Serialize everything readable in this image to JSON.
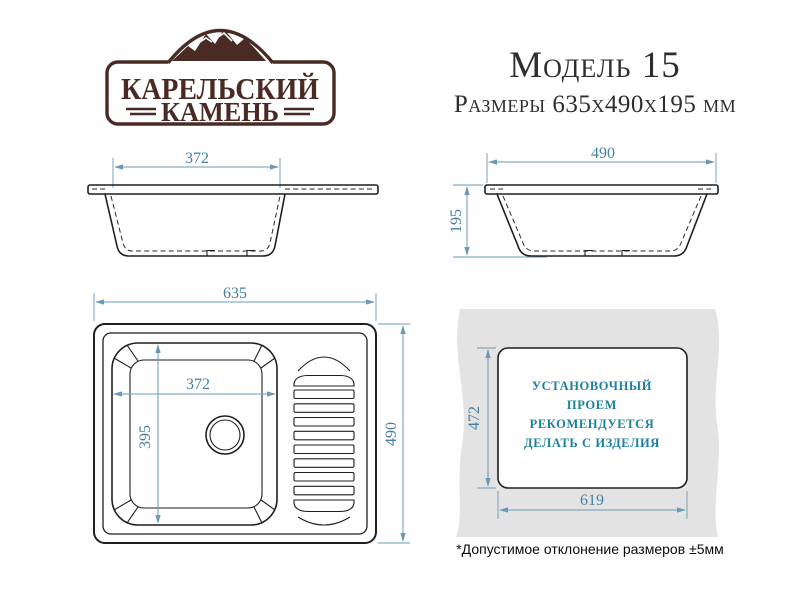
{
  "brand": {
    "line1": "КАРЕЛЬСКИЙ",
    "line2": "КАМЕНЬ"
  },
  "header": {
    "model": "Модель 15",
    "size_line": "Размеры 635х490х195 мм"
  },
  "front_view": {
    "bowl_width_mm": "372"
  },
  "side_view": {
    "depth_mm": "490",
    "height_mm": "195"
  },
  "top_view": {
    "overall_width_mm": "635",
    "overall_depth_mm": "490",
    "bowl_width_mm": "372",
    "bowl_length_mm": "395"
  },
  "cutout_view": {
    "opening_height_mm": "472",
    "opening_width_mm": "619",
    "note_lines": [
      "УСТАНОВОЧНЫЙ",
      "ПРОЕМ",
      "РЕКОМЕНДУЕТСЯ",
      "ДЕЛАТЬ С ИЗДЕЛИЯ"
    ]
  },
  "footnote": "*Допустимое отклонение размеров  ±5мм",
  "colors": {
    "dimension_line": "#6b98b4",
    "dimension_text": "#47809c",
    "drawing_line": "#1f1f1f",
    "brand_brown": "#4a2b23",
    "note_teal": "#1c7f9c",
    "countertop_gray": "#e3e3e3"
  }
}
